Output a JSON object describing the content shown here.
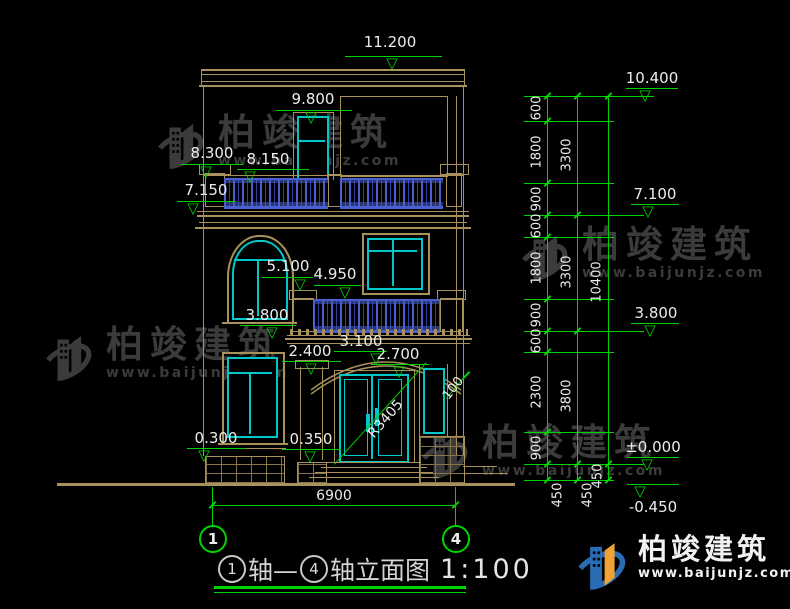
{
  "markers": {
    "left": [
      "11.200",
      "9.800",
      "8.300",
      "8.150",
      "7.150",
      "5.100",
      "4.950",
      "3.800",
      "3.100",
      "2.700",
      "2.400",
      "0.300",
      "0.350"
    ],
    "right": [
      "10.400",
      "7.100",
      "3.800",
      "±0.000",
      "-0.450"
    ]
  },
  "chains": {
    "inner": [
      "600",
      "1800",
      "900",
      "600",
      "1800",
      "900",
      "600",
      "2300",
      "900"
    ],
    "middle": [
      "3300",
      "3300",
      "3800"
    ],
    "outer": [
      "10400"
    ],
    "below": [
      "450",
      "450",
      "450"
    ]
  },
  "dims": {
    "width": "6900",
    "radius": "R3405",
    "offset": "100"
  },
  "axes": [
    "1",
    "4"
  ],
  "title": {
    "axis_start": "1",
    "mid": "轴—",
    "axis_end": "4",
    "tail": "轴立面图",
    "scale": "1:100"
  },
  "watermark": {
    "brand": "柏竣建筑",
    "url": "www.baijunjz.com"
  },
  "logo": {
    "brand": "柏竣建筑",
    "url": "www.baijunjz.com"
  },
  "colors": {
    "outline": "#a8915a",
    "glass": "#00c8c8",
    "dimension": "#00d400",
    "baluster": "#4a5fd0",
    "text": "#ececec",
    "watermark": "#3b3b3b",
    "logo_blue": "#2a6db5",
    "logo_orange": "#f0a335"
  }
}
